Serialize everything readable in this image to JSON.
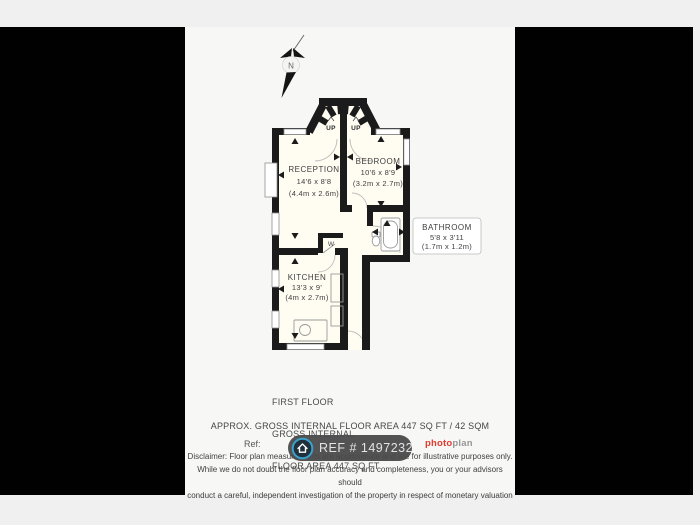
{
  "compass": {
    "label": "N"
  },
  "stairs": {
    "up_label": "UP"
  },
  "closet": {
    "label": "W"
  },
  "rooms": {
    "reception": {
      "name": "RECEPTION",
      "imperial": "14'6 x 8'8",
      "metric": "(4.4m x 2.6m)"
    },
    "bedroom": {
      "name": "BEDROOM",
      "imperial": "10'6 x 8'9",
      "metric": "(3.2m x 2.7m)"
    },
    "bathroom": {
      "name": "BATHROOM",
      "imperial": "5'8 x 3'11",
      "metric": "(1.7m x 1.2m)"
    },
    "kitchen": {
      "name": "KITCHEN",
      "imperial": "13'3 x 9'",
      "metric": "(4m x 2.7m)"
    }
  },
  "floor_summary": {
    "line1": "FIRST FLOOR",
    "line2": "GROSS INTERNAL",
    "line3": "FLOOR AREA 447 SQ FT"
  },
  "footer": {
    "approx_line": "APPROX. GROSS INTERNAL FLOOR AREA 447 SQ FT / 42 SQM",
    "ref_label": "Ref:",
    "ref_badge": "REF # 1497232",
    "logo": {
      "part1": "photo",
      "part2": "plan"
    },
    "disclaimer_lines": [
      "Disclaimer: Floor plan measurements are approximate and are for illustrative purposes only.",
      "While we do not doubt the floor plan accuracy and completeness, you or your advisors should",
      "conduct a careful, independent investigation of the property in respect of monetary valuation"
    ]
  },
  "colors": {
    "wall": "#1b1b1b",
    "accent_red": "#e23a2e",
    "badge_background": "#4a4a4a",
    "badge_icon_ring": "#39a1cb"
  }
}
